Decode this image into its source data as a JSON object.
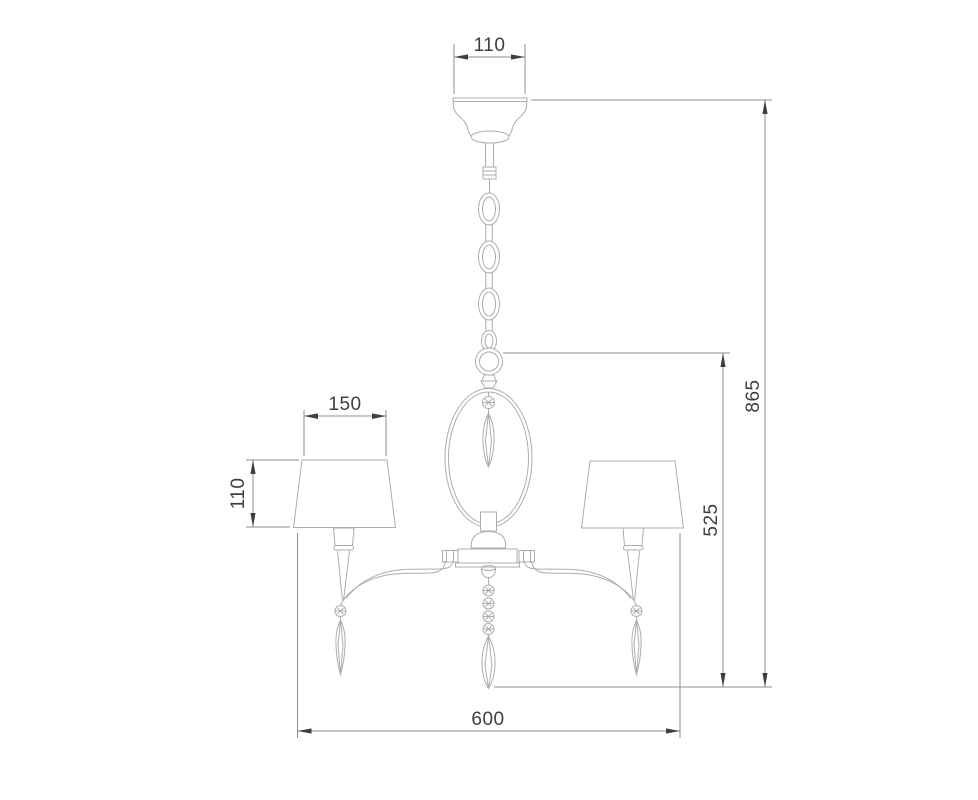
{
  "colors": {
    "outline": "#a9aeb2",
    "dim_line": "#8a9094",
    "accent": "#3c4043",
    "bg": "#ffffff"
  },
  "drawing": {
    "type": "technical-dimension-drawing",
    "subject": "Three-arm chandelier with tapered fabric shades, chain suspension, oval decorative frame and faceted crystal drops (front elevation)",
    "units_shown": "none (numeric values only)",
    "dimensions": {
      "canopy_width": {
        "value": "110",
        "orientation": "horizontal",
        "measures": "ceiling canopy width"
      },
      "shade_width": {
        "value": "150",
        "orientation": "horizontal",
        "measures": "lamp shade top width"
      },
      "shade_height": {
        "value": "110",
        "orientation": "vertical",
        "measures": "lamp shade height"
      },
      "overall_height": {
        "value": "865",
        "orientation": "vertical",
        "measures": "total height from canopy to lowest crystal tip"
      },
      "height_below_ring": {
        "value": "525",
        "orientation": "vertical",
        "measures": "height from suspension ring to lowest crystal tip"
      },
      "overall_width": {
        "value": "600",
        "orientation": "horizontal",
        "measures": "overall fixture width across shades"
      }
    },
    "components": [
      "ceiling canopy",
      "suspension chain with oval links",
      "suspension ring",
      "oval decorative frame with inner crystal drop",
      "central hub body",
      "left curved arm",
      "right curved arm",
      "left candle cup and shade",
      "right candle cup and shade",
      "three hanging faceted crystal drops",
      "center bead string"
    ]
  }
}
